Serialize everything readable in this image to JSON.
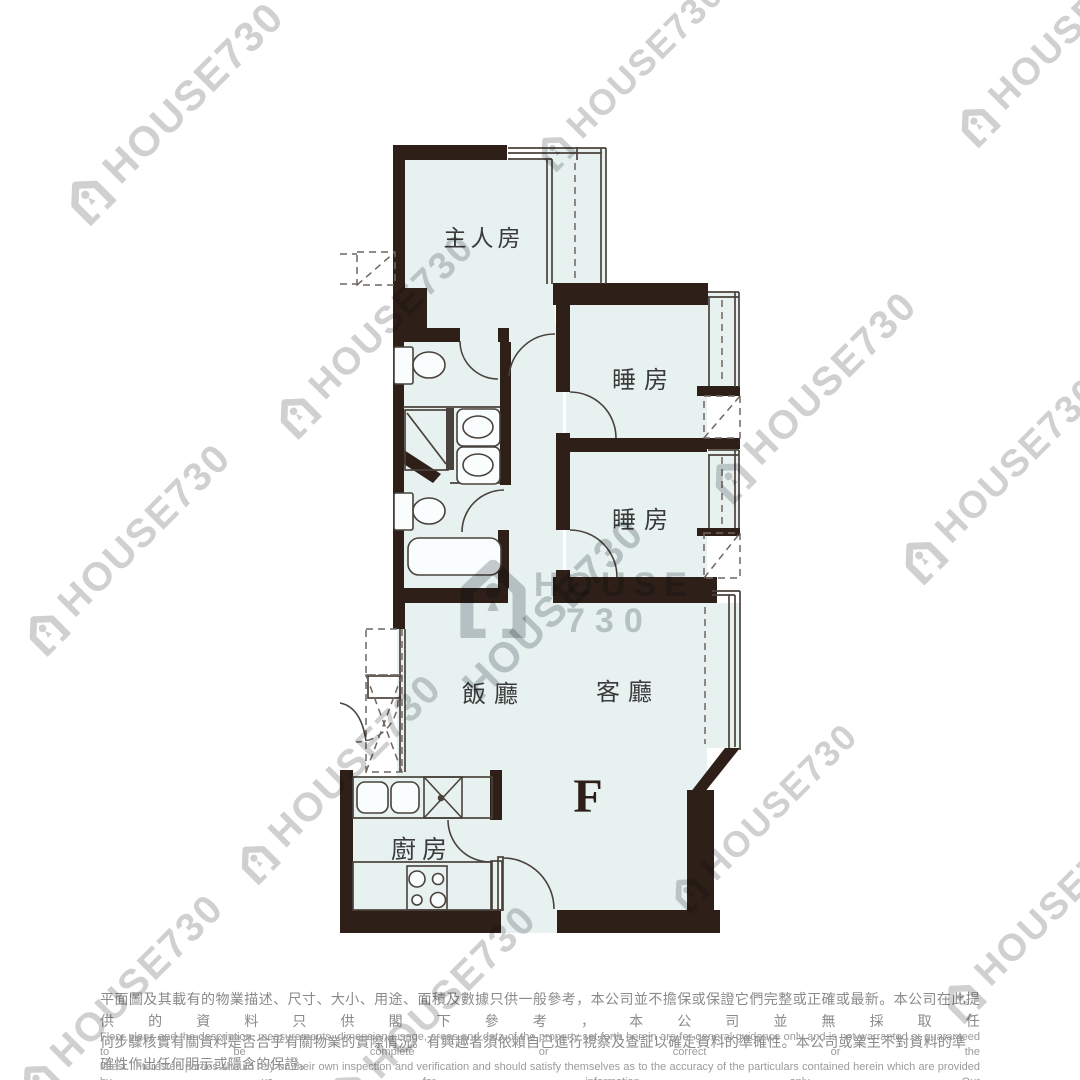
{
  "floor_plan": {
    "unit_label": "F",
    "rooms": {
      "master_bedroom": "主人房",
      "bedroom_1": "睡房",
      "bedroom_2": "睡房",
      "dining_room": "飯廳",
      "living_room": "客廳",
      "kitchen": "廚房"
    }
  },
  "watermark": {
    "text": "HOUSE730",
    "word": "HOUSE",
    "number": "730"
  },
  "disclaimer": {
    "zh_line_1": "平面圖及其載有的物業描述、尺寸、大小、用途、面積及數據只供一般參考，本公司並不擔保或保證它們完整或正確或最新。本公司在此提供的資料只供閣下參考，本公司並無採取任",
    "zh_line_2": "何步驟核實有關資料是否合乎有關物業的實際情況。有興趣者須依賴自己進行視察及查証以確定資料的準確性。本公司或業主不對資料的準確性作出任何明示或隱含的保證。",
    "en_line_1": "Floor plans and the description, measurements, dimension, usage, areas and data of the property set forth herein are for general guidance only and is not warranted or guaranteed to be complete or correct or the",
    "en_line_2": "latest. Interested parties should rely on their own inspection and verification and should satisfy themselves as to the accuracy of the particulars contained herein which are provided by us for information only.  Our",
    "en_line_3": "Company has not taken any step to verify whether the information reflects the actual status of the property.  No warranty for accuracy is given or implied by the owners or us."
  },
  "colors": {
    "wall": "#2e2019",
    "floor": "#e6f1f0",
    "line": "#4a423c",
    "watermark": "#d0d0d1"
  }
}
